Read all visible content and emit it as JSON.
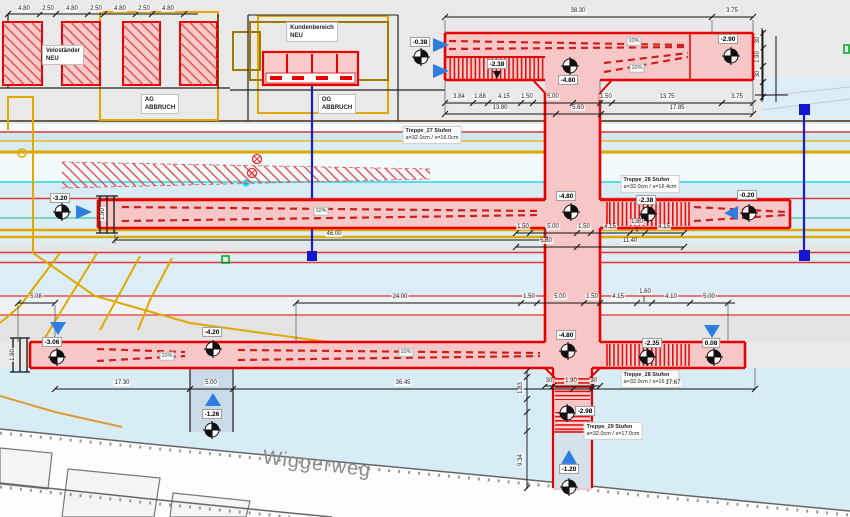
{
  "areas": {
    "velostaender": "Veloständer\nNEU",
    "ag_abbruch": "AG\nABBRUCH",
    "kundenbereich": "Kundenbereich\nNEU",
    "og_abbruch": "OG\nABBRUCH"
  },
  "street": {
    "name": "Wiggerweg"
  },
  "stairs": [
    {
      "name": "Treppe_27 Stufen",
      "spec": "a=32.0cm / s=16.0cm"
    },
    {
      "name": "Treppe_28 Stufen",
      "spec": "a=32.0cm / s=16.4cm"
    },
    {
      "name": "Treppe_28 Stufen",
      "spec": "a=32.0cm / s=16.4cm"
    },
    {
      "name": "Treppe_29 Stufen",
      "spec": "a=32.0cm / s=17.0cm"
    }
  ],
  "levels": {
    "top_entry": "-0.38",
    "top_stair": "-2.38",
    "top_center": "-4.80",
    "top_end": "-2.90",
    "mid_entry": "-3.20",
    "mid_center": "-4.80",
    "mid_stair": "-2.38",
    "mid_end": "-0.20",
    "bot_entry": "-3.06",
    "bot_landing": "-4.20",
    "bot_center": "-4.80",
    "bot_stair": "-2.35",
    "bot_end": "0.08",
    "shaft_west_street": "-1.26",
    "south_stair": "-2.98",
    "south_street": "-1.20"
  },
  "slope": "10%",
  "dims": {
    "rack": [
      "4.80",
      "2.50",
      "4.80",
      "2.50",
      "4.80",
      "2.50",
      "4.80"
    ],
    "top_total": "38.30",
    "top_end_len": "3.75",
    "top_r1": [
      "3.84",
      "1.88",
      "4.15",
      "1.50",
      "5.00",
      "1.50",
      "13.75",
      "3.75"
    ],
    "top_r2": [
      "13.80",
      "5.60",
      "17.85"
    ],
    "mid_total": "46.00",
    "mid_r1": [
      "1.50",
      "5.00",
      "1.50",
      "4.15",
      "1.60",
      "4.15"
    ],
    "mid_r2": [
      "5.60",
      "11.40"
    ],
    "bot_r1": [
      "24.00",
      "1.50",
      "5.00",
      "1.50",
      "4.15",
      "1.60",
      "4.10",
      "5.00"
    ],
    "bot_r2": [
      "17.30",
      "5.00",
      "36.45",
      "17.67"
    ],
    "west": "5.08",
    "shaft_w": [
      "30",
      "1.90",
      "30"
    ],
    "lane": "1.90",
    "south_v": [
      "1.83",
      "9.34"
    ]
  },
  "colors": {
    "corridor_fill": "#f7c6c6",
    "corridor_border": "#e60000",
    "track_yellow": "#e0a800",
    "track_cyan": "#2fd8e6",
    "arrow_blue": "#2e7de0",
    "cable_blue": "#1c1ccc",
    "background": "#e9e9e9",
    "water_blue": "#d8ecf6"
  }
}
